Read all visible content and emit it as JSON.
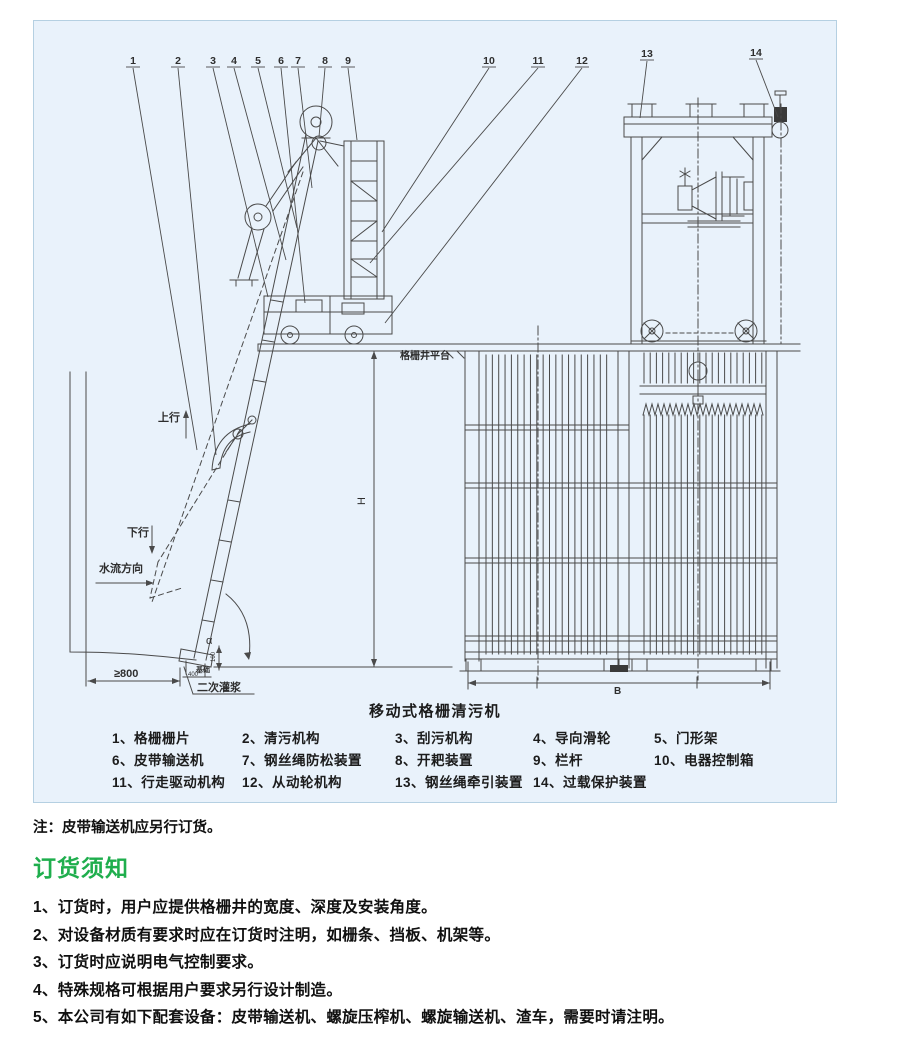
{
  "colors": {
    "page_bg": "#ffffff",
    "panel_bg": "#e9f2fb",
    "panel_border": "#b5d0e2",
    "line": "#4a4a4a",
    "text": "#111111",
    "heading_green": "#1fae4d"
  },
  "drawing": {
    "title": "移动式格栅清污机",
    "callouts": [
      {
        "num": "1",
        "x": 133,
        "y": 64,
        "tx": 197,
        "ty": 450
      },
      {
        "num": "2",
        "x": 178,
        "y": 64,
        "tx": 216,
        "ty": 455
      },
      {
        "num": "3",
        "x": 213,
        "y": 64,
        "tx": 268,
        "ty": 297
      },
      {
        "num": "4",
        "x": 234,
        "y": 64,
        "tx": 286,
        "ty": 260
      },
      {
        "num": "5",
        "x": 258,
        "y": 64,
        "tx": 297,
        "ty": 228
      },
      {
        "num": "6",
        "x": 281,
        "y": 64,
        "tx": 305,
        "ty": 303
      },
      {
        "num": "7",
        "x": 298,
        "y": 64,
        "tx": 312,
        "ty": 188
      },
      {
        "num": "8",
        "x": 325,
        "y": 64,
        "tx": 319,
        "ty": 137
      },
      {
        "num": "9",
        "x": 348,
        "y": 64,
        "tx": 357,
        "ty": 140
      },
      {
        "num": "10",
        "x": 489,
        "y": 64,
        "tx": 382,
        "ty": 232
      },
      {
        "num": "11",
        "x": 538,
        "y": 64,
        "tx": 370,
        "ty": 263
      },
      {
        "num": "12",
        "x": 582,
        "y": 64,
        "tx": 385,
        "ty": 323
      },
      {
        "num": "13",
        "x": 647,
        "y": 57,
        "tx": 640,
        "ty": 118
      },
      {
        "num": "14",
        "x": 756,
        "y": 56,
        "tx": 778,
        "ty": 117
      }
    ],
    "labels": [
      {
        "text": "上行",
        "x": 158,
        "y": 421,
        "size": 11,
        "bold": true
      },
      {
        "text": "下行",
        "x": 127,
        "y": 536,
        "size": 11,
        "bold": true
      },
      {
        "text": "水流方向",
        "x": 99,
        "y": 572,
        "size": 11,
        "bold": true
      },
      {
        "text": "格栅井平台",
        "x": 400,
        "y": 359,
        "size": 10,
        "bold": true
      },
      {
        "text": "H",
        "x": 365,
        "y": 501,
        "size": 11,
        "rotate": -90
      },
      {
        "text": "α",
        "x": 206,
        "y": 644,
        "size": 11
      },
      {
        "text": "≥800",
        "x": 114,
        "y": 677,
        "size": 11,
        "bold": true
      },
      {
        "text": "400",
        "x": 188,
        "y": 676,
        "size": 6
      },
      {
        "text": "100",
        "x": 215,
        "y": 657,
        "size": 6,
        "rotate": -90
      },
      {
        "text": "基础",
        "x": 196,
        "y": 672,
        "size": 7,
        "bold": true
      },
      {
        "text": "二次灌浆",
        "x": 197,
        "y": 691,
        "size": 11,
        "bold": true
      },
      {
        "text": "B",
        "x": 614,
        "y": 694,
        "size": 10,
        "bold": true
      }
    ]
  },
  "legend": {
    "rows": [
      [
        "1、格栅栅片",
        "2、清污机构",
        "3、刮污机构",
        "4、导向滑轮",
        "5、门形架"
      ],
      [
        "6、皮带输送机",
        "7、钢丝绳防松装置",
        "8、开耙装置",
        "9、栏杆",
        "10、电器控制箱"
      ],
      [
        "11、行走驱动机构",
        "12、从动轮机构",
        "13、钢丝绳牵引装置",
        "14、过载保护装置"
      ]
    ]
  },
  "note": "注：皮带输送机应另行订货。",
  "order_section": {
    "heading": "订货须知",
    "items": [
      "1、订货时，用户应提供格栅井的宽度、深度及安装角度。",
      "2、对设备材质有要求时应在订货时注明，如栅条、挡板、机架等。",
      "3、订货时应说明电气控制要求。",
      "4、特殊规格可根据用户要求另行设计制造。",
      "5、本公司有如下配套设备：皮带输送机、螺旋压榨机、螺旋输送机、渣车，需要时请注明。"
    ]
  }
}
